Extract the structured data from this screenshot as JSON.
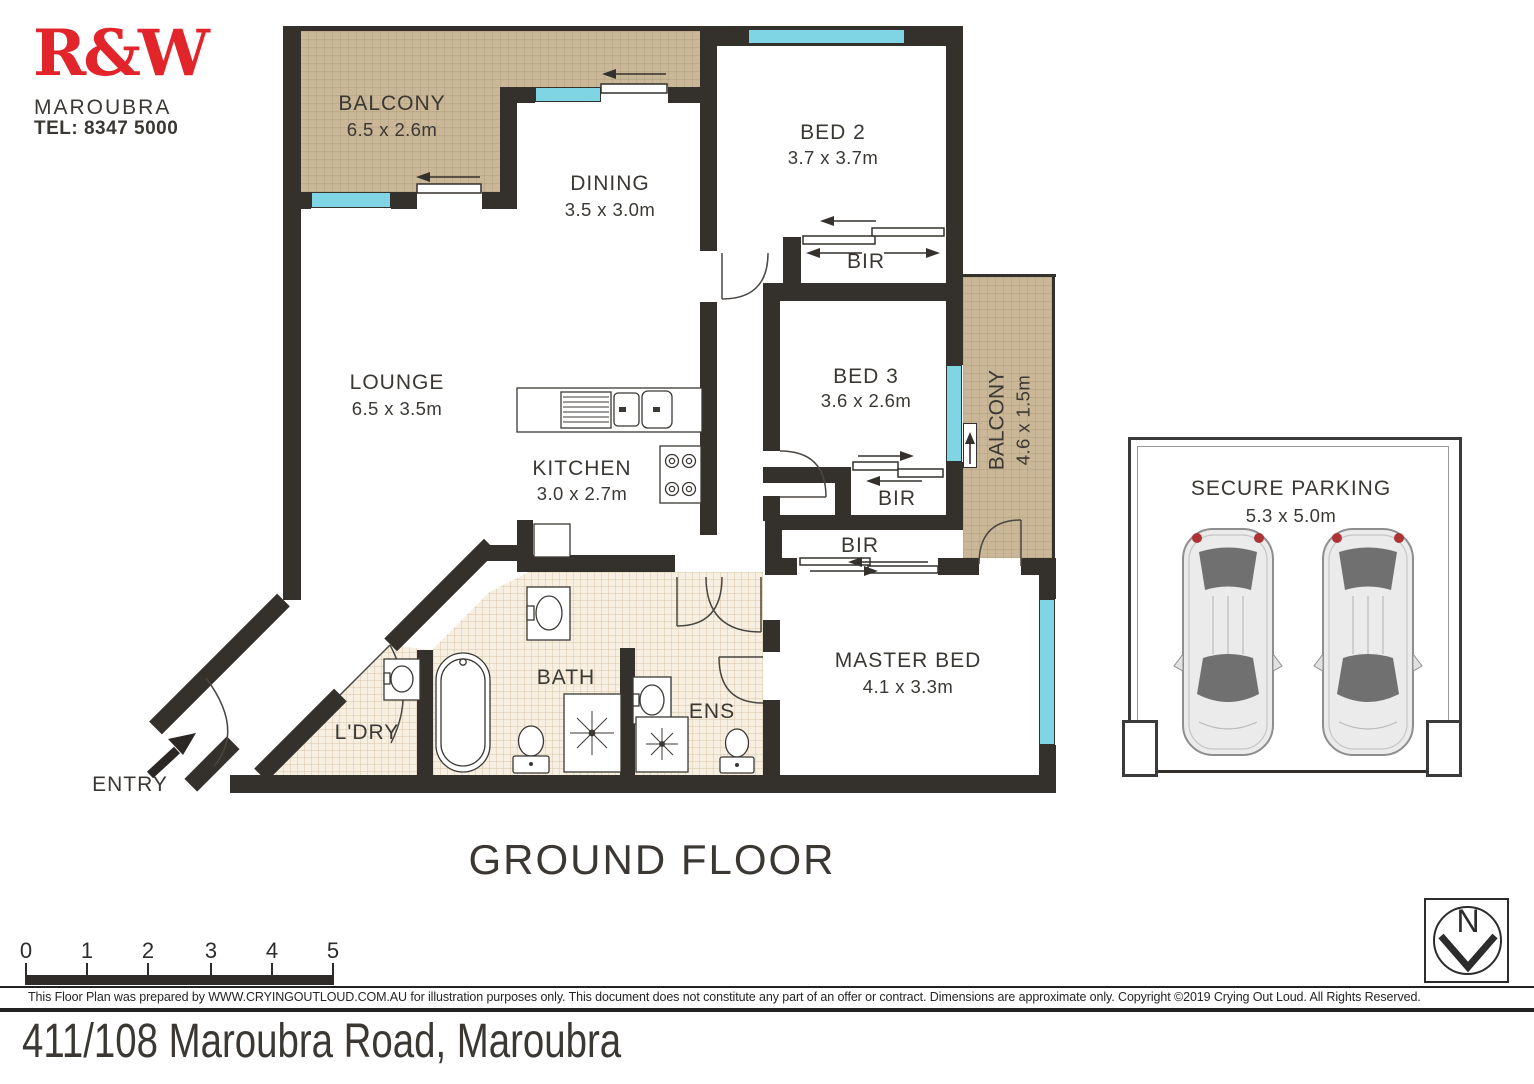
{
  "brand": {
    "logo_text": "R&W",
    "office_name": "MAROUBRA",
    "phone": "TEL: 8347 5000"
  },
  "floor_plan": {
    "title": "GROUND FLOOR",
    "rooms": [
      {
        "name": "BALCONY",
        "dims": "6.5 x 2.6m"
      },
      {
        "name": "DINING",
        "dims": "3.5 x 3.0m"
      },
      {
        "name": "BED 2",
        "dims": "3.7 x 3.7m"
      },
      {
        "name": "BIR"
      },
      {
        "name": "BED 3",
        "dims": "3.6 x 2.6m"
      },
      {
        "name": "BALCONY",
        "dims": "4.6 x 1.5m"
      },
      {
        "name": "LOUNGE",
        "dims": "6.5 x 3.5m"
      },
      {
        "name": "KITCHEN",
        "dims": "3.0 x 2.7m"
      },
      {
        "name": "BIR"
      },
      {
        "name": "BIR"
      },
      {
        "name": "MASTER BED",
        "dims": "4.1 x 3.3m"
      },
      {
        "name": "BATH"
      },
      {
        "name": "ENS"
      },
      {
        "name": "L'DRY"
      },
      {
        "name": "ENTRY"
      },
      {
        "name": "SECURE PARKING",
        "dims": "5.3 x 5.0m"
      }
    ]
  },
  "scale_bar": {
    "labels": [
      "0",
      "1",
      "2",
      "3",
      "4",
      "5"
    ]
  },
  "compass": {
    "label": "N"
  },
  "footer": {
    "disclaimer": "This Floor Plan was prepared by WWW.CRYINGOUTLOUD.COM.AU for illustration purposes only. This document does not constitute any part of an offer or contract. Dimensions are approximate only. Copyright ©2019 Crying Out Loud. All Rights Reserved.",
    "address": "411/108 Maroubra Road, Maroubra"
  },
  "colors": {
    "wall": "#34302C",
    "window": "#7FD5E3",
    "balcony_fill": "#C9B798",
    "tile_fill": "#F7F0E2",
    "brand_red": "#E2242B",
    "car_body": "#EBEBEB",
    "car_glass": "#707070",
    "tail_light": "#AE3334"
  }
}
